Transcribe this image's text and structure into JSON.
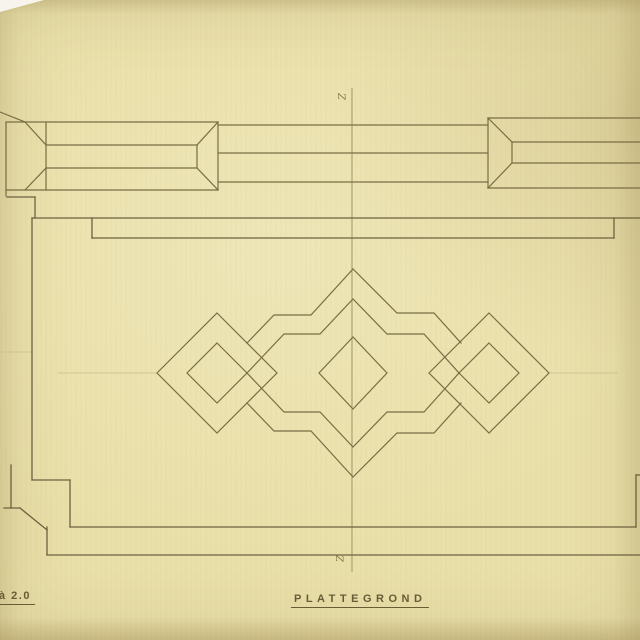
{
  "drawing": {
    "title": "PLATTEGROND",
    "scale_note": "à 2.0",
    "axis_mark_top": "Z",
    "axis_mark_bottom": "Z"
  },
  "colors": {
    "paper": "#e9dfa8",
    "paper_edge": "#d8cc95",
    "ink": "#7a6e45",
    "ink_strong": "#6d6140",
    "centerline": "#9a8d5e",
    "faint_pencil": "#c9bd8c",
    "label_text": "#675c36",
    "photo_corner_white": "#f6f4ed"
  }
}
